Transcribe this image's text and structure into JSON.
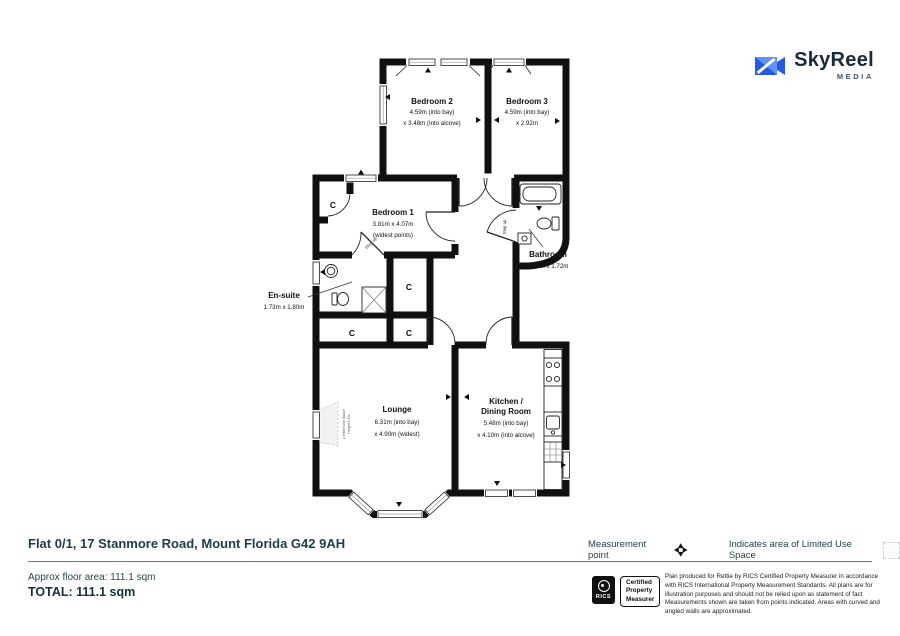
{
  "logo": {
    "name": "SkyReel",
    "sub": "MEDIA",
    "accent_dark": "#2458e6",
    "accent_light": "#6292f8",
    "text_color": "#182a3d"
  },
  "plan": {
    "wall_color": "#101010",
    "rooms": [
      {
        "name": "Bedroom 2",
        "dim1": "4.59m (into bay)",
        "dim2": "x 3.48m (into alcove)"
      },
      {
        "name": "Bedroom 3",
        "dim1": "4.59m (into bay)",
        "dim2": "x 2.92m"
      },
      {
        "name": "Bedroom 1",
        "dim1": "3.81m x 4.07m",
        "dim2": "(widest points)"
      },
      {
        "name": "En-suite",
        "dim1": "1.73m x 1.80m"
      },
      {
        "name": "Bathroom",
        "dim1": "1.89m x 1.72m"
      },
      {
        "name": "Lounge",
        "dim1": "6.31m (into bay)",
        "dim2": "x 4.90m (widest)"
      },
      {
        "name": "Kitchen /",
        "name2": "Dining Room",
        "dim1": "5.48m (into bay)",
        "dim2": "x 4.10m (into alcove)"
      }
    ],
    "annotations": {
      "cupboard": "C",
      "step_up": "Step up",
      "limited_use_1": "Limited Use Space",
      "limited_use_2": "Height 1.5m"
    }
  },
  "footer": {
    "address": "Flat 0/1, 17 Stanmore Road, Mount Florida G42 9AH",
    "approx_area": "Approx floor area: 111.1 sqm",
    "total": "TOTAL: 111.1 sqm",
    "legend": {
      "measurement_point": "Measurement point",
      "limited_use": "Indicates area of  Limited Use Space"
    },
    "rics": {
      "logo_text": "RICS",
      "badge_line1": "Certified",
      "badge_line2": "Property",
      "badge_line3": "Measurer"
    },
    "disclaimer": "Plan produced for Rettie by RICS Certified Property Measurer in accordance with RICS International Property  Measurement Standards.  All plans are for illustration purposes and should not be relied upon as statement of fact Measurements shown are taken from points indicated. Areas with curved and angled walls are approximated."
  }
}
